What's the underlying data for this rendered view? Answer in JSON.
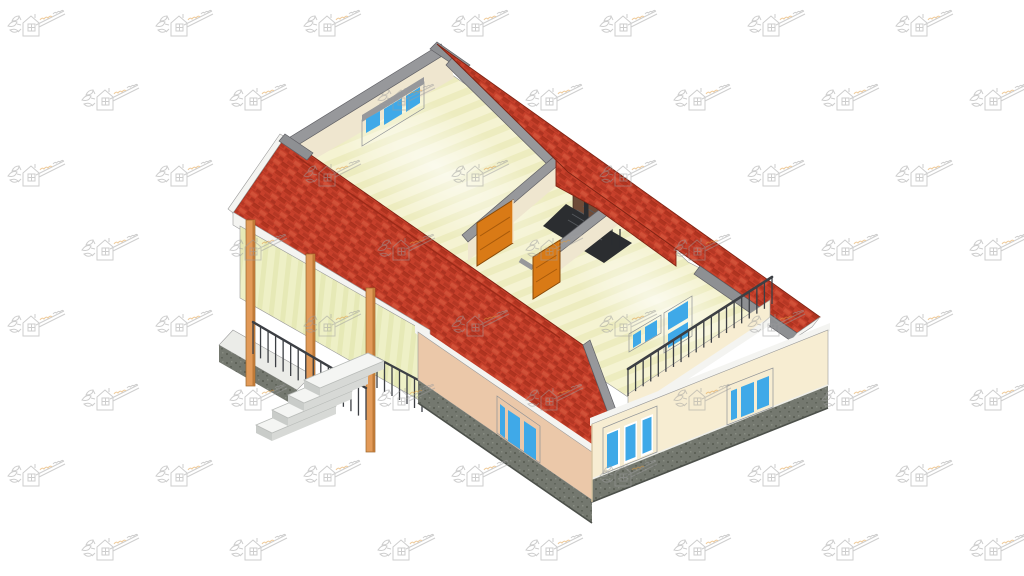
{
  "scene": {
    "subject": "isometric-3d-cutaway-house-model",
    "canvas": {
      "width": 1024,
      "height": 576
    }
  },
  "palette": {
    "background": "#ffffff",
    "roof_red": "#c7402b",
    "roof_red_dark": "#9c2a18",
    "roof_red_deep": "#8f2414",
    "roof_red_light": "#d95b41",
    "ridge_gray": "#8e9093",
    "fascia_white": "#f4f4f1",
    "wall_cut_gray": "#97989b",
    "interior_wall_cream": "#efe6cf",
    "floor_pale": "#f5f3d2",
    "floor_stripe": "#ebe9b8",
    "exterior_wall_cream": "#f7edd2",
    "exterior_wall_peach": "#ebc8a9",
    "plinth_gray": "#74786f",
    "plinth_dark": "#54584f",
    "window_blue": "#3fa9e8",
    "window_blue_deep": "#2288c8",
    "window_frame": "#ffffff",
    "frame_gray": "#c7cacd",
    "door_orange": "#d97a16",
    "door_orange_dark": "#a85a0b",
    "stair_dark": "#2b2d30",
    "stair_highlight": "#55585c",
    "railing_dark": "#3c3f44",
    "porch_wall": "#eef0c6",
    "porch_wall_stripe": "#e4e7b2",
    "porch_floor": "#ebece8",
    "step_white": "#f4f5f3",
    "step_shade": "#d7d9d6",
    "step_side": "#c9ccc9",
    "column_orange": "#e29a58",
    "column_orange_dark": "#bf7a38",
    "stair_wall_brown": "#6e4b38",
    "watermark_gray": "#9c9c9c",
    "watermark_orange": "#e09a3e"
  },
  "watermark": {
    "icon": "house-leaf-logo",
    "tile_width": 148,
    "tile_height": 150,
    "opacity": 0.5
  }
}
